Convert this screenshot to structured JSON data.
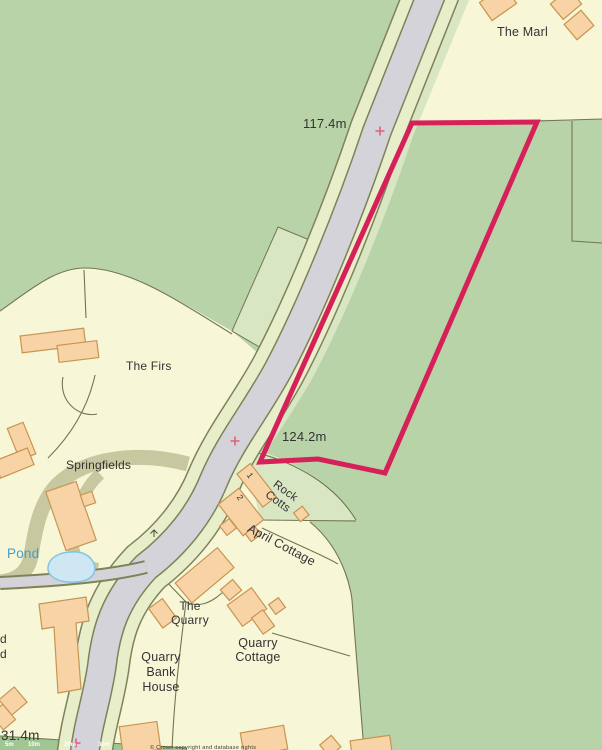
{
  "map": {
    "labels": {
      "the_marl": "The Marl",
      "spot_height_top": "117.4m",
      "spot_height_mid": "124.2m",
      "spot_height_bottom": "31.4m",
      "the_firs": "The Firs",
      "springfields": "Springfields",
      "pond": "Pond",
      "rock_cotts_1": "Rock",
      "rock_cotts_2": "Cotts",
      "april_cottage": "April Cottage",
      "house_number_1": "1",
      "house_number_2": "2",
      "the_quarry_1": "The",
      "the_quarry_2": "Quarry",
      "quarry_cottage_1": "Quarry",
      "quarry_cottage_2": "Cottage",
      "quarry_bank_house_1": "Quarry",
      "quarry_bank_house_2": "Bank",
      "quarry_bank_house_3": "House",
      "edge_cut_text_1": "d",
      "edge_cut_text_2": "d",
      "scale_tick_1": "5m",
      "scale_tick_2": "10m",
      "scale_tick_3": "20m",
      "scale_tick_4": "30m",
      "attribution_fragment": "© Crown copyright and database rights"
    },
    "colors": {
      "land-yellow": "#f7f6d7",
      "field-green": "#b9d3a8",
      "pale-green": "#d9e6c3",
      "line": "#72764f",
      "road-gray": "#d3d3d9",
      "casing": "#7e8259",
      "verge": "#e7eec9",
      "khaki": "#c8c8a0",
      "scale-green": "#a0c693",
      "parcel-red": "#d62059",
      "cross-red": "#e4607a",
      "bldg": "#f8d3a5",
      "bldg-line": "#c79552",
      "pond-fill": "#cfe7f3",
      "pond-stroke": "#82c5e2",
      "pond-text": "#3f9fce",
      "label": "#333333"
    }
  }
}
